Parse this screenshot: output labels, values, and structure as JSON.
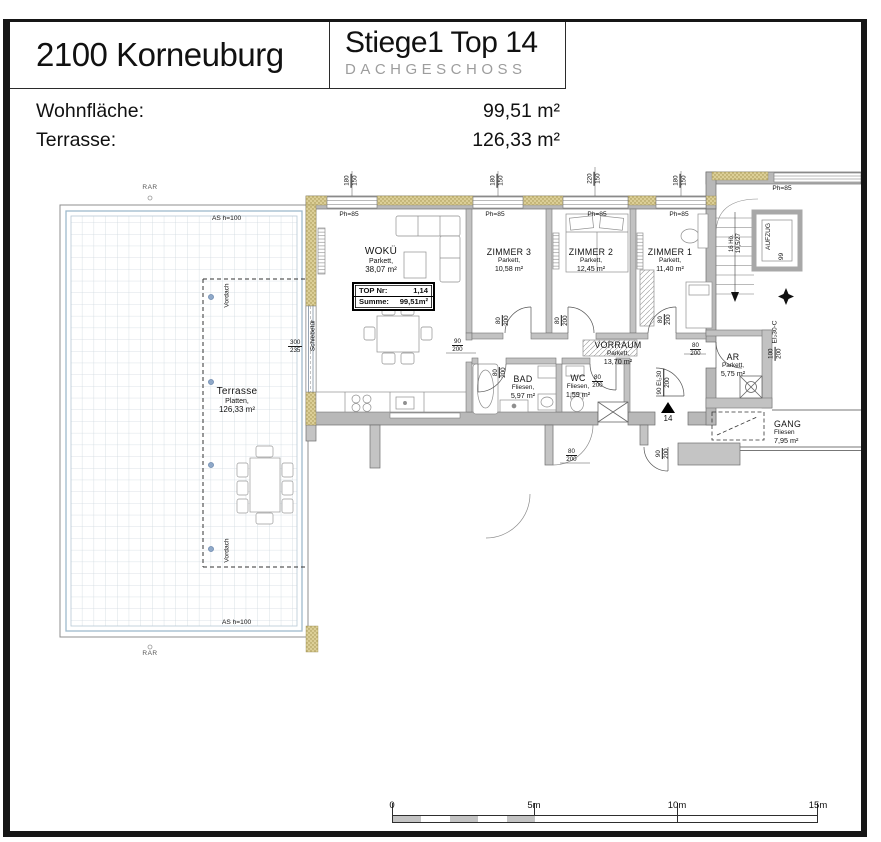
{
  "header": {
    "location": "2100 Korneuburg",
    "unit": "Stiege1 Top 14",
    "floor": "DACHGESCHOSS"
  },
  "areas": {
    "wohnflaeche_label": "Wohnfläche:",
    "wohnflaeche_value": "99,51 m²",
    "terrasse_label": "Terrasse:",
    "terrasse_value": "126,33 m²"
  },
  "plan": {
    "top_box": {
      "label1": "TOP Nr:",
      "value1": "1,14",
      "label2": "Summe:",
      "value2": "99,51m²"
    },
    "rooms": [
      {
        "name": "WOKÜ",
        "finish": "Parkett,",
        "area": "38,07 m²"
      },
      {
        "name": "ZIMMER 3",
        "finish": "Parkett,",
        "area": "10,58 m²"
      },
      {
        "name": "ZIMMER 2",
        "finish": "Parkett,",
        "area": "12,45 m²"
      },
      {
        "name": "ZIMMER 1",
        "finish": "Parkett,",
        "area": "11,40 m²"
      },
      {
        "name": "VORRAUM",
        "finish": "Parkett,",
        "area": "13,70 m²"
      },
      {
        "name": "BAD",
        "finish": "Fliesen,",
        "area": "5,97 m²"
      },
      {
        "name": "WC",
        "finish": "Fliesen,",
        "area": "1,59 m²"
      },
      {
        "name": "AR",
        "finish": "Parkett,",
        "area": "5,75 m²"
      },
      {
        "name": "GANG",
        "finish": "Fliesen",
        "area": "7,95 m²"
      },
      {
        "name": "Terrasse",
        "finish": "Platten,",
        "area": "126,33 m²"
      }
    ],
    "labels": {
      "ph85": "Ph=85",
      "as_h100": "AS h=100",
      "rar": "RAR",
      "vordach": "Vordach",
      "schiebetuer": "Schiebetür",
      "aufzug": "AUFZUG",
      "stairs_line1": "16 Hö.",
      "stairs_line2": "19,5/27",
      "entrance_number": "14",
      "elevator_note": "99"
    },
    "dims": {
      "n80": "80",
      "n90": "90",
      "n200": "200",
      "n180": "180",
      "n150": "150",
      "n220": "220",
      "n300": "300",
      "n235": "235",
      "entry_door": "90 EI₂30",
      "gang_door_width": "100",
      "gang_door_spec": "EI₂30-C"
    },
    "colors": {
      "wall_gray": "#b8b8b8",
      "insulation_tan": "#dccf97",
      "terrace_grid": "#cfd9e0",
      "terrace_frame": "#9fb9cc",
      "dot_blue": "#8fa8c8"
    }
  },
  "scalebar": {
    "t0": "0",
    "t5": "5m",
    "t10": "10m",
    "t15": "15m"
  }
}
